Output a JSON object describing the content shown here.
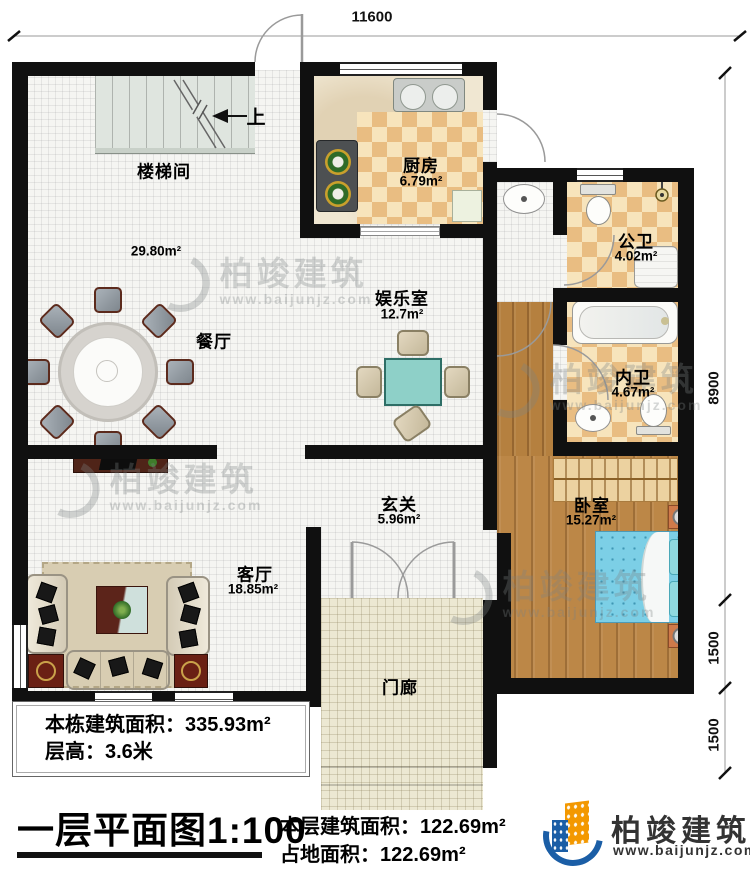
{
  "plan": {
    "rooms": {
      "staircase": {
        "name": "楼梯间"
      },
      "dining": {
        "name": "餐厅",
        "area": "29.80m²"
      },
      "kitchen": {
        "name": "厨房",
        "area": "6.79m²"
      },
      "public_bath": {
        "name": "公卫",
        "area": "4.02m²"
      },
      "private_bath": {
        "name": "内卫",
        "area": "4.67m²"
      },
      "entertainment": {
        "name": "娱乐室",
        "area": "12.7m²"
      },
      "bedroom": {
        "name": "卧室",
        "area": "15.27m²"
      },
      "hallway": {
        "name": "玄关",
        "area": "5.96m²"
      },
      "living": {
        "name": "客厅",
        "area": "18.85m²"
      },
      "porch": {
        "name": "门廊"
      }
    },
    "stairs": {
      "up_label": "上"
    },
    "dimensions": {
      "top": "11600",
      "right_upper": "8900",
      "right_mid": "1500",
      "right_lower": "1500"
    }
  },
  "info_box": {
    "line1": "本栋建筑面积：335.93m²",
    "line2": "层高：3.6米"
  },
  "footer": {
    "title": "一层平面图1:100",
    "line1": "本层建筑面积：122.69m²",
    "line2": "占地面积：122.69m²"
  },
  "logo": {
    "name": "柏竣建筑",
    "url": "www.baijunjz.com"
  },
  "watermark": {
    "name": "柏竣建筑",
    "url": "www.baijunjz.com"
  },
  "colors": {
    "wall": "#101010",
    "checker_light": "#f7e4bc",
    "checker_dark": "#e9bd82",
    "wood": "#b5803f",
    "bed_blue": "#7ccfe6",
    "game_table_teal": "#8ed0c8",
    "logo_orange": "#f39800",
    "logo_blue": "#1b5ea6"
  }
}
